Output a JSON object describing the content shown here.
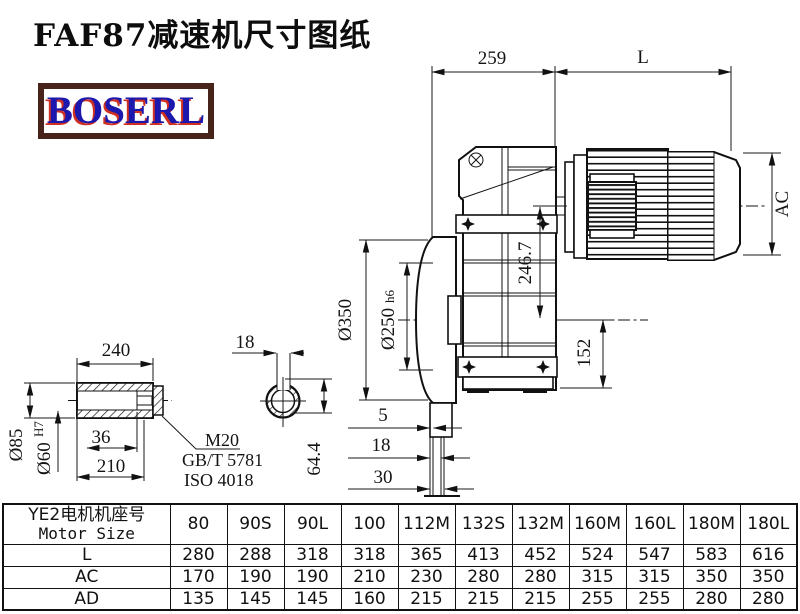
{
  "title": "FAF87减速机尺寸图纸",
  "logo": {
    "text": "BOSERL",
    "text_color": "#1c17ad",
    "shadow_color": "#d03022",
    "border_color": "#47231b"
  },
  "drawing": {
    "dims": {
      "top_width": "259",
      "motor_length_label": "L",
      "motor_diameter_label": "AC",
      "center_height": "246.7",
      "flange_od": "Ø350",
      "spigot": {
        "d": "Ø250",
        "tol": "h6"
      },
      "output_center_height": "152",
      "wall_5": "5",
      "wall_18": "18",
      "wall_30": "30",
      "hub_length": "240",
      "keyway_width": "18",
      "shaft_od": "Ø85",
      "bore": {
        "d": "Ø60",
        "tol": "H7"
      },
      "dim_36": "36",
      "dim_210": "210",
      "thread": "M20",
      "std_gb": "GB/T 5781",
      "std_iso": "ISO 4018",
      "keyway_height": "64.4"
    }
  },
  "table": {
    "header_cn": "YE2电机机座号",
    "header_en": "Motor Size",
    "columns": [
      "80",
      "90S",
      "90L",
      "100",
      "112M",
      "132S",
      "132M",
      "160M",
      "160L",
      "180M",
      "180L"
    ],
    "rows": [
      {
        "label": "L",
        "values": [
          "280",
          "288",
          "318",
          "318",
          "365",
          "413",
          "452",
          "524",
          "547",
          "583",
          "616"
        ]
      },
      {
        "label": "AC",
        "values": [
          "170",
          "190",
          "190",
          "210",
          "230",
          "280",
          "280",
          "315",
          "315",
          "350",
          "350"
        ]
      },
      {
        "label": "AD",
        "values": [
          "135",
          "145",
          "145",
          "160",
          "215",
          "215",
          "215",
          "255",
          "255",
          "280",
          "280"
        ]
      }
    ]
  }
}
